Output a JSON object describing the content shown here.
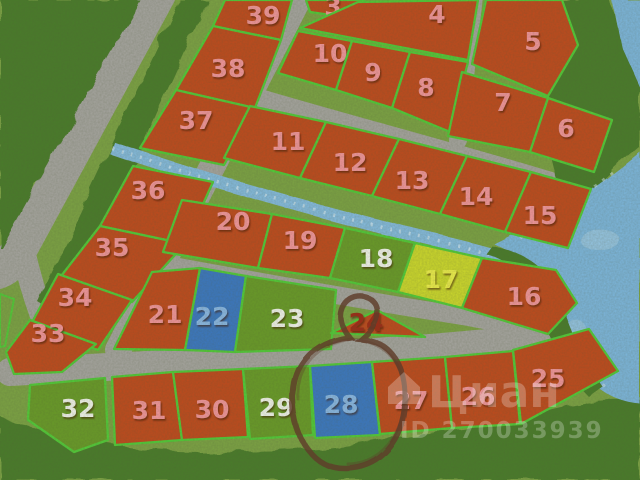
{
  "map": {
    "title": "land-plot-scheme",
    "watermark": {
      "logo_text": "Циан",
      "id_text": "ID 270033939"
    },
    "annotation": {
      "circled_plot": "28"
    },
    "colors": {
      "orange": "#c04a1d",
      "green": "#699b28",
      "blue": "#3b78c2",
      "yellow": "#cdd92c",
      "border": "#52cc38",
      "pink_label": "#f5969c",
      "white_label": "#f4f6ee",
      "blue_label": "#8ab9e8",
      "yellow_label": "#eff04b",
      "darkred_label": "#9e2b15",
      "circle": "#5e3d2c",
      "watermark": "#ffffff",
      "road": "#a6a5a0",
      "grass": "#7ca344",
      "forest": "#4a7b2b",
      "water": "#7db7de"
    },
    "plots": [
      {
        "n": "3",
        "x": 333,
        "y": 15,
        "pts": "306,0 364,0 352,18 310,12"
      },
      {
        "n": "39",
        "x": 263,
        "y": 24,
        "pts": "213,26 225,0 292,0 281,40"
      },
      {
        "n": "38",
        "x": 228,
        "y": 77,
        "pts": "176,90 213,26 281,40 255,108"
      },
      {
        "n": "37",
        "x": 196,
        "y": 129,
        "pts": "140,148 176,90 255,108 224,165"
      },
      {
        "n": "36",
        "x": 148,
        "y": 199,
        "pts": "100,226 133,166 213,182 185,244"
      },
      {
        "n": "35",
        "x": 112,
        "y": 256,
        "pts": "58,280 100,226 185,244 132,302"
      },
      {
        "n": "34",
        "x": 75,
        "y": 306,
        "pts": "30,326 58,274 132,300 98,350"
      },
      {
        "n": "33",
        "x": 48,
        "y": 342,
        "pts": "6,352 30,320 96,344 62,372 14,374"
      },
      {
        "n": "4",
        "x": 437,
        "y": 23,
        "pts": "358,2 478,0 468,60 300,28"
      },
      {
        "n": "10",
        "x": 330,
        "y": 62,
        "pts": "298,31 352,41 336,90 278,73"
      },
      {
        "n": "9",
        "x": 373,
        "y": 81,
        "pts": "352,41 410,52 392,108 336,90"
      },
      {
        "n": "8",
        "x": 426,
        "y": 96,
        "pts": "410,52 468,62 450,132 392,108"
      },
      {
        "n": "5",
        "x": 533,
        "y": 50,
        "pts": "486,0 562,0 578,45 548,96 472,64"
      },
      {
        "n": "7",
        "x": 503,
        "y": 111,
        "pts": "462,72 548,98 530,152 448,136"
      },
      {
        "n": "6",
        "x": 566,
        "y": 137,
        "pts": "548,98 612,120 594,172 530,152"
      },
      {
        "n": "11",
        "x": 288,
        "y": 150,
        "pts": "250,106 326,122 300,178 224,158"
      },
      {
        "n": "12",
        "x": 350,
        "y": 171,
        "pts": "326,122 399,139 372,196 300,178"
      },
      {
        "n": "13",
        "x": 412,
        "y": 189,
        "pts": "399,139 467,156 440,214 372,196"
      },
      {
        "n": "14",
        "x": 476,
        "y": 205,
        "pts": "467,156 531,172 505,232 440,214"
      },
      {
        "n": "15",
        "x": 540,
        "y": 224,
        "pts": "531,172 591,189 568,248 505,232"
      },
      {
        "n": "20",
        "x": 233,
        "y": 230,
        "pts": "182,200 272,214 258,268 163,252"
      },
      {
        "n": "19",
        "x": 300,
        "y": 249,
        "pts": "272,214 345,228 330,278 258,268"
      },
      {
        "n": "18",
        "fill": "green",
        "label": "white_label",
        "x": 376,
        "y": 267,
        "pts": "345,228 415,243 398,292 330,278"
      },
      {
        "n": "17",
        "fill": "yellow",
        "label": "yellow_label",
        "x": 441,
        "y": 288,
        "pts": "415,243 482,258 462,308 398,292"
      },
      {
        "n": "16",
        "x": 524,
        "y": 305,
        "pts": "482,258 556,270 577,303 548,334 462,308"
      },
      {
        "n": "21",
        "x": 165,
        "y": 323,
        "pts": "152,272 200,268 185,350 114,349"
      },
      {
        "n": "22",
        "fill": "blue",
        "label": "blue_label",
        "x": 212,
        "y": 325,
        "pts": "200,268 246,276 235,352 185,350"
      },
      {
        "n": "23",
        "fill": "green",
        "label": "white_label",
        "x": 287,
        "y": 327,
        "pts": "246,276 336,290 331,349 235,352"
      },
      {
        "n": "24",
        "label": "darkred_label",
        "x": 366,
        "y": 331,
        "pts": "331,333 377,310 425,337"
      },
      {
        "n": "32",
        "fill": "green",
        "label": "white_label",
        "x": 78,
        "y": 417,
        "pts": "30,385 105,378 108,440 74,452 28,420"
      },
      {
        "n": "31",
        "x": 149,
        "y": 419,
        "pts": "112,377 173,372 182,440 115,445"
      },
      {
        "n": "30",
        "x": 212,
        "y": 418,
        "pts": "173,372 243,369 248,437 182,440"
      },
      {
        "n": "29",
        "fill": "green",
        "label": "white_label",
        "x": 276,
        "y": 416,
        "pts": "243,369 310,366 313,435 250,439"
      },
      {
        "n": "28",
        "fill": "blue",
        "label": "blue_label",
        "x": 341,
        "y": 413,
        "pts": "310,366 372,362 380,435 315,438"
      },
      {
        "n": "27",
        "x": 411,
        "y": 409,
        "pts": "372,362 445,357 452,428 380,434"
      },
      {
        "n": "26",
        "x": 478,
        "y": 405,
        "pts": "445,357 513,351 520,424 452,428"
      },
      {
        "n": "25",
        "x": 548,
        "y": 387,
        "pts": "513,350 589,329 618,371 521,424"
      }
    ]
  }
}
